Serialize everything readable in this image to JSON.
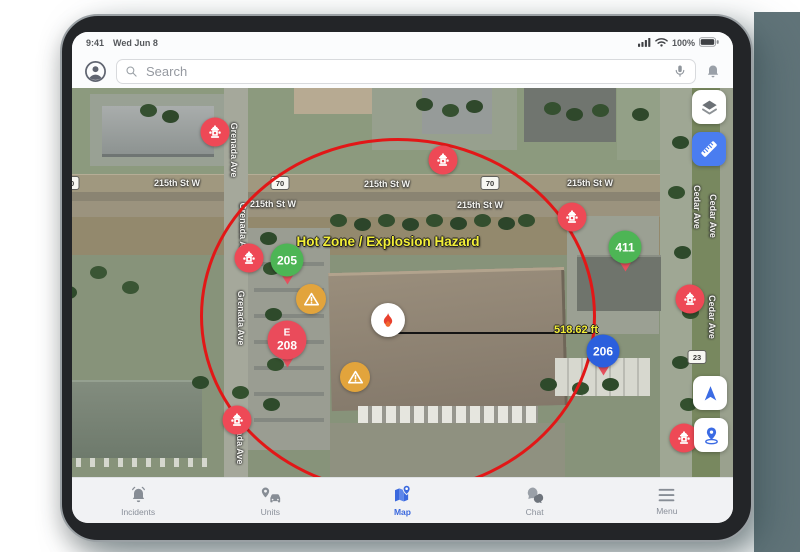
{
  "status_bar": {
    "time": "9:41",
    "date": "Wed Jun 8",
    "battery_pct": "100%"
  },
  "header": {
    "search_placeholder": "Search"
  },
  "map": {
    "hot_zone_label": "Hot Zone / Explosion Hazard",
    "distance_label": "518.62 ft",
    "street_labels": {
      "street_215": "215th St W",
      "grenada": "Grenada Ave",
      "cedar": "Cedar Ave"
    },
    "shields": {
      "hwy70": "70",
      "hwy23": "23"
    },
    "units": [
      {
        "label": "205",
        "color": "#4db555"
      },
      {
        "label": "411",
        "color": "#4db555"
      },
      {
        "label": "206",
        "color": "#2b5fdd"
      },
      {
        "line1": "E",
        "line2": "208",
        "color": "#ea4b5b"
      }
    ]
  },
  "bottom_nav": {
    "items": [
      {
        "label": "Incidents",
        "active": false
      },
      {
        "label": "Units",
        "active": false
      },
      {
        "label": "Map",
        "active": true
      },
      {
        "label": "Chat",
        "active": false
      },
      {
        "label": "Menu",
        "active": false
      }
    ]
  },
  "icons": {
    "header": [
      "avatar-icon",
      "search-icon",
      "mic-icon",
      "bell-icon"
    ],
    "status": [
      "signal-icon",
      "wifi-icon",
      "battery-icon"
    ],
    "map_controls": [
      "layers-icon",
      "ruler-icon",
      "navigation-arrow-icon",
      "drop-pin-icon"
    ],
    "markers": [
      "fire-hydrant-icon",
      "flame-icon",
      "warning-triangle-icon"
    ],
    "bottom_nav": [
      "incidents-bell-icon",
      "units-vehicle-icon",
      "map-icon",
      "chat-icon",
      "menu-icon"
    ]
  },
  "colors": {
    "accent_blue": "#3b69de",
    "hot_zone_red": "#e21717",
    "hydrant_red": "#ee4956",
    "pin_green": "#4db555",
    "pin_blue": "#2b5fdd",
    "pin_red": "#ea4b5b",
    "warning_amber": "#e2a43c",
    "hazard_yellow": "#f3ef37",
    "backdrop_teal": "#617479"
  }
}
